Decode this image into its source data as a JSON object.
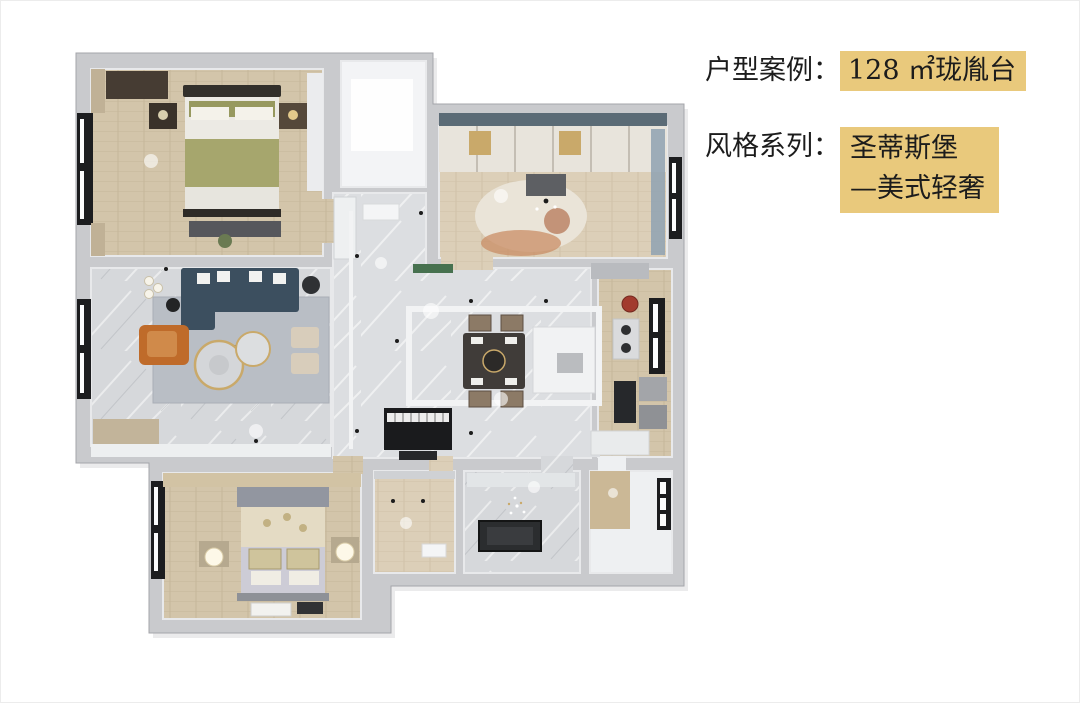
{
  "info_panel": {
    "case_label": "户型案例：",
    "case_value": "128 ㎡珑胤台",
    "style_label": "风格系列：",
    "style_value_line1": "圣蒂斯堡",
    "style_value_line2": "—美式轻奢"
  },
  "palette": {
    "background": "#ffffff",
    "highlight": "#e9c97c",
    "text": "#1c1c1c",
    "wall": "#c9cacd",
    "wall_edge": "#a4a5aa",
    "marble": "#d6d8db",
    "marble_light": "#dcdee1",
    "wood": "#d3c5aa",
    "wood_light": "#dccfb8",
    "white_room": "#f3f4f6",
    "sofa": "#3c4f5f",
    "armchair": "#bf6b2a",
    "bed_green": "#a6a66d",
    "piano": "#1a1b1d",
    "tub": "#2b2d2f",
    "window": "#1c1d1f",
    "gold": "#c9a96a",
    "accent_red": "#a23b2e",
    "accent_green": "#47714f"
  }
}
